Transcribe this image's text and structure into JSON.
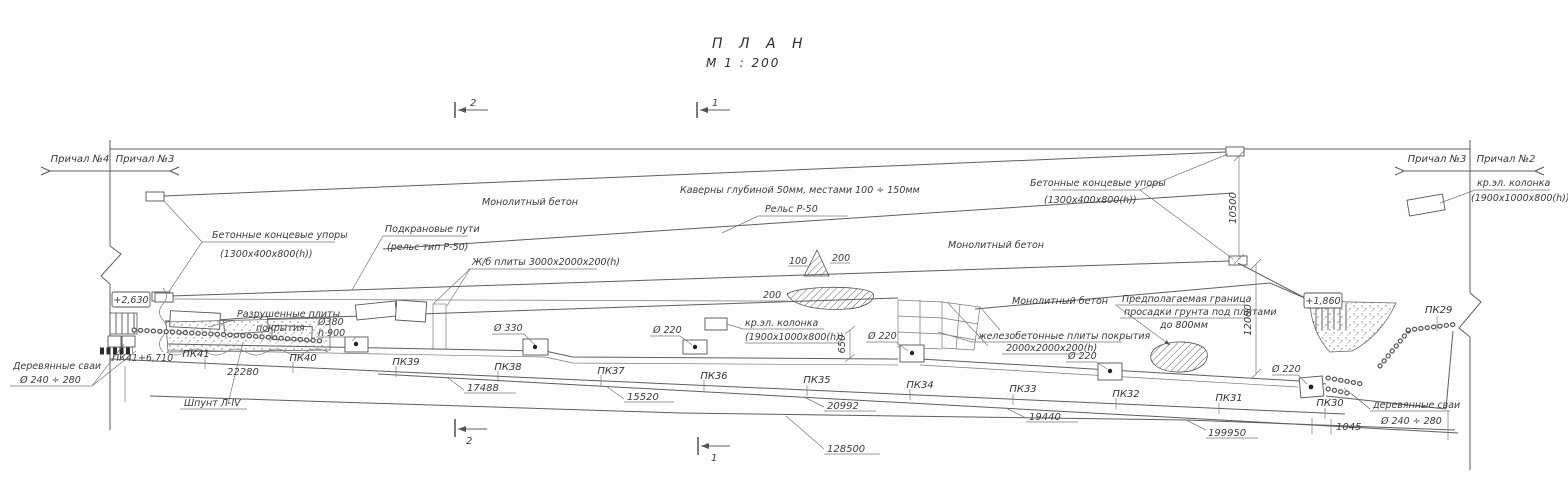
{
  "title": {
    "main": "П Л А Н",
    "scale": "М  1 : 200"
  },
  "section_marks": {
    "left": "2",
    "right": "1"
  },
  "berths": {
    "far_left": "Причал №4",
    "left": "Причал №3",
    "right": "Причал №3",
    "far_right": "Причал №2"
  },
  "callouts": {
    "end_stops_line1": "Бетонные концевые упоры",
    "end_stops_line2": "(1300x400x800(h))",
    "crane_rails_line1": "Подкрановые пути",
    "crane_rails_line2": "(рельс тип  Р-50)",
    "monolithic": "Монолитный бетон",
    "caverns": "Каверны глубиной 50мм, местами 100 ÷ 150мм",
    "rail": "Рельс  Р-50",
    "column_line1": "кр.эл. колонка",
    "column_line2": "(1900x1000x800(h))",
    "slabs": "Ж/б плиты 3000x2000x200(h)",
    "rc_slabs_line1": "железобетонные плиты покрытия",
    "rc_slabs_line2": "2000x2000x200(h)",
    "subsidence_line1": "Предполагаемая граница",
    "subsidence_line2": "просадки грунта под плитами",
    "subsidence_line3": "до 800мм",
    "destroyed_line1": "Разрушенные плиты",
    "destroyed_line2": "покрытия",
    "wood_piles_left": "Деревянные сваи",
    "wood_piles_right": "деревянные сваи",
    "wood_piles_dia": "Ø 240 ÷ 280",
    "sheet_pile": "Шпунт  Л-IV",
    "bollard_380_line1": "Ø380",
    "bollard_380_line2": "h 900",
    "bollard_330": "Ø 330",
    "bollard_220": "Ø 220",
    "cavity_100": "100",
    "cavity_200": "200"
  },
  "elevations": {
    "left": "+2,630",
    "right": "+1,860"
  },
  "stations": {
    "pk41_offset": "ПК41+6,710",
    "pk41": "ПК41",
    "pk40": "ПК40",
    "pk39": "ПК39",
    "pk38": "ПК38",
    "pk37": "ПК37",
    "pk36": "ПК36",
    "pk35": "ПК35",
    "pk34": "ПК34",
    "pk33": "ПК33",
    "pk32": "ПК32",
    "pk31": "ПК31",
    "pk30": "ПК30",
    "pk29": "ПК29"
  },
  "dimensions": {
    "seg_22280": "22280",
    "seg_17488": "17488",
    "seg_15520": "15520",
    "seg_20992": "20992",
    "seg_19440": "19440",
    "seg_1045": "1045",
    "total_199950": "199950",
    "total_128500": "128500",
    "offset_650": "650",
    "gauge_10500": "10500",
    "width_12000": "12000"
  }
}
